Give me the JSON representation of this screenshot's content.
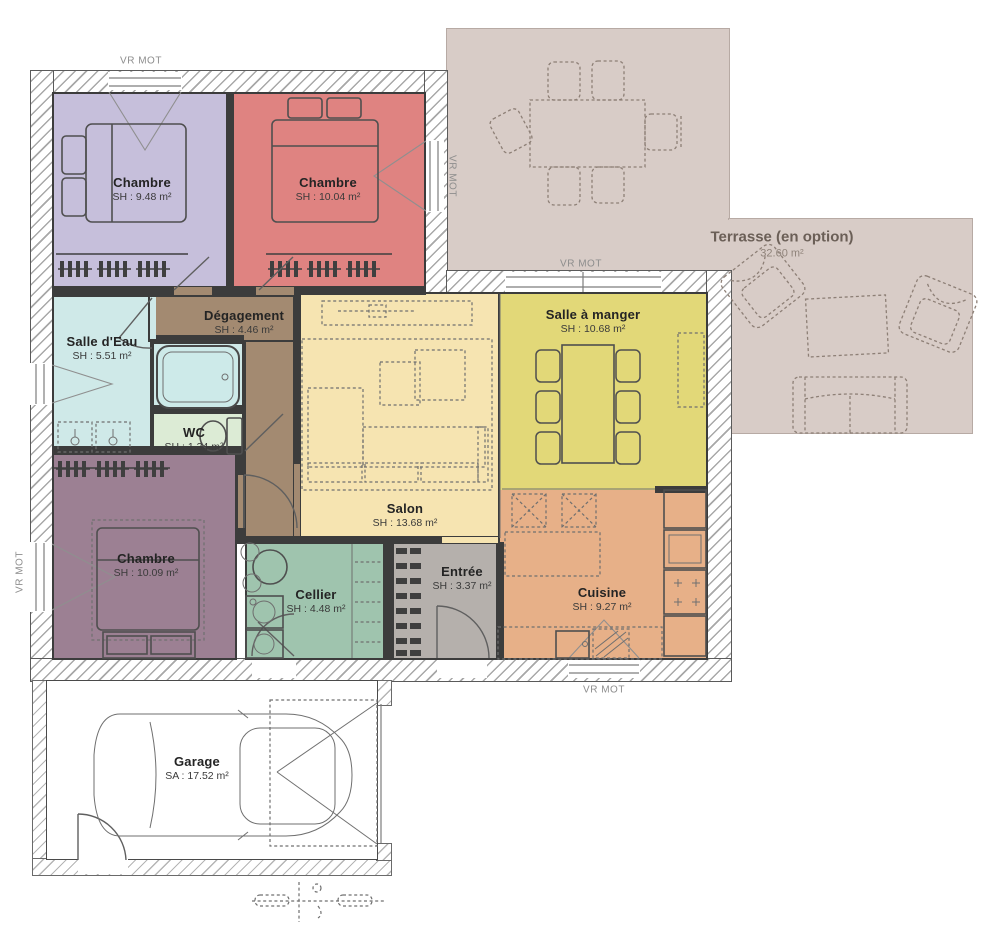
{
  "plan": {
    "shutter_label": "VR MOT",
    "rooms": {
      "chambre1": {
        "name": "Chambre",
        "area": "SH : 9.48 m²"
      },
      "chambre2": {
        "name": "Chambre",
        "area": "SH : 10.04 m²"
      },
      "salle_deau": {
        "name": "Salle d'Eau",
        "area": "SH : 5.51 m²"
      },
      "degagement": {
        "name": "Dégagement",
        "area": "SH : 4.46 m²"
      },
      "wc": {
        "name": "WC",
        "area": "SH : 1.34 m²"
      },
      "salon": {
        "name": "Salon",
        "area": "SH : 13.68 m²"
      },
      "salle_a_manger": {
        "name": "Salle à manger",
        "area": "SH : 10.68 m²"
      },
      "cuisine": {
        "name": "Cuisine",
        "area": "SH : 9.27 m²"
      },
      "cellier": {
        "name": "Cellier",
        "area": "SH : 4.48 m²"
      },
      "entree": {
        "name": "Entrée",
        "area": "SH : 3.37 m²"
      },
      "chambre3": {
        "name": "Chambre",
        "area": "SH : 10.09 m²"
      },
      "garage": {
        "name": "Garage",
        "area": "SA : 17.52 m²"
      },
      "terrasse": {
        "name": "Terrasse (en option)",
        "area": "32.60 m²"
      }
    },
    "colors": {
      "chambre_lavande": "#c6bfdb",
      "chambre_rouge": "#df8381",
      "chambre_mauve": "#9c8093",
      "salle_deau": "#cfe9e8",
      "wc": "#dcebd5",
      "degagement": "#a38a71",
      "salon": "#f6e4b1",
      "salle_a_manger": "#e2d878",
      "cuisine": "#e7b088",
      "cellier": "#9fc4ae",
      "entree": "#b5b0ac",
      "terrasse": "#d8ccc7",
      "baignoire": "#cdeae9",
      "mur": "#3c3c3c"
    }
  }
}
